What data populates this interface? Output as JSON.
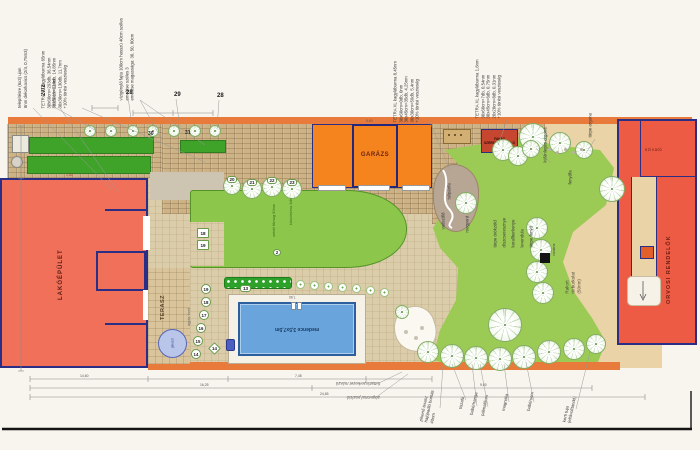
{
  "plan": {
    "buildings": {
      "house": "LAKÓÉPÜLET",
      "garage": "GARÁZS",
      "shed": "FAHÁZ\nSZERSZÁMTÁROLÓ",
      "clinic": "ORVOSI RENDELŐK",
      "clinic_top": "szivató"
    },
    "areas": {
      "terrace": "TERASZ",
      "jacuzzi": "jakuzzi",
      "pool": "medence 3,5x7,5m",
      "lawn_center": "vetett fűmag 90nm",
      "climbing_rose": "kúszórózsa 3db",
      "paved_right": "Rakott\ntérburkolat\n(50nm)",
      "water_shaft": "vízakna",
      "bed_front": "ágyás front",
      "pine": "fenyőfa"
    },
    "notes": {
      "gravel": "telepítésre (6x3) ujan\n8nm dekorkavics (2/4, 0,75m3)",
      "gravel2": "m2/6 16+12nm",
      "tetra1": "TETRA XL kagylóburma 65nm\n30x60cm=293db, 36,54nm\n30x60cm=110db, 14,85nm\n30x30cm=130db, 11,7nm\n+10% törési veszteség",
      "planting": "vízigénylő fajta 100cm hosszú 40cm széles\nemelése széles 3\nemelése magassága: 30, 50, 80cm",
      "tetra2": "TETRA XL kagylóburma 8,45nm\n30x60cm=0db, 0nm\n30x45cm=35db, 4,25nm\n30x30cm=59db, 5,4nm\n+10% törési veszteség",
      "tetra3": "TETRA XL kagylóburma 1,6nm\n30x60cm=7db, 0,54nm\n30x45cm=6db, 0,75nm\n20x20cm=8db, 0,31nm\n+10% törési veszteség",
      "special_lilac": "különleges orgona",
      "dwarf_lilac": "törpe orgona",
      "crawler1": "futtatószerkezet mászó",
      "crawler2": "alapvonal pozíció"
    },
    "markers": {
      "parcel": "27/2",
      "m28a": "28",
      "m29": "29",
      "m28b": "28",
      "m30": "30",
      "m31": "31",
      "lawn": [
        "20",
        "21",
        "22",
        "23"
      ],
      "m2": "2",
      "m13": "13",
      "squares": [
        "18",
        "19"
      ],
      "curve": [
        "19",
        "18",
        "17",
        "16",
        "15",
        "14"
      ],
      "diamond": "14"
    },
    "plants_right": {
      "tulipanfa": "tulipánfa",
      "cluster": [
        "törpe örökzöld",
        "díszcseresznye",
        "korallberkenye",
        "levendula",
        "törpe fenyő"
      ],
      "vadszolo": "vadszőlő",
      "mogyoro": "mogyoró"
    },
    "plants_bottom": [
      "pihenő terasz\nhajópadló bontás\n40nm",
      "tiszafa",
      "babérhanga",
      "pálmaliliom",
      "magnólia",
      "babérsom",
      "kerti tuja\n(eltávolítandó)"
    ],
    "dims": {
      "d1": "14,60",
      "d2": "7,45",
      "d3": "16,25",
      "d4": "9,80",
      "d5": "24,65",
      "pool": "7,50",
      "garage": "5,60",
      "house": "1,50"
    }
  }
}
